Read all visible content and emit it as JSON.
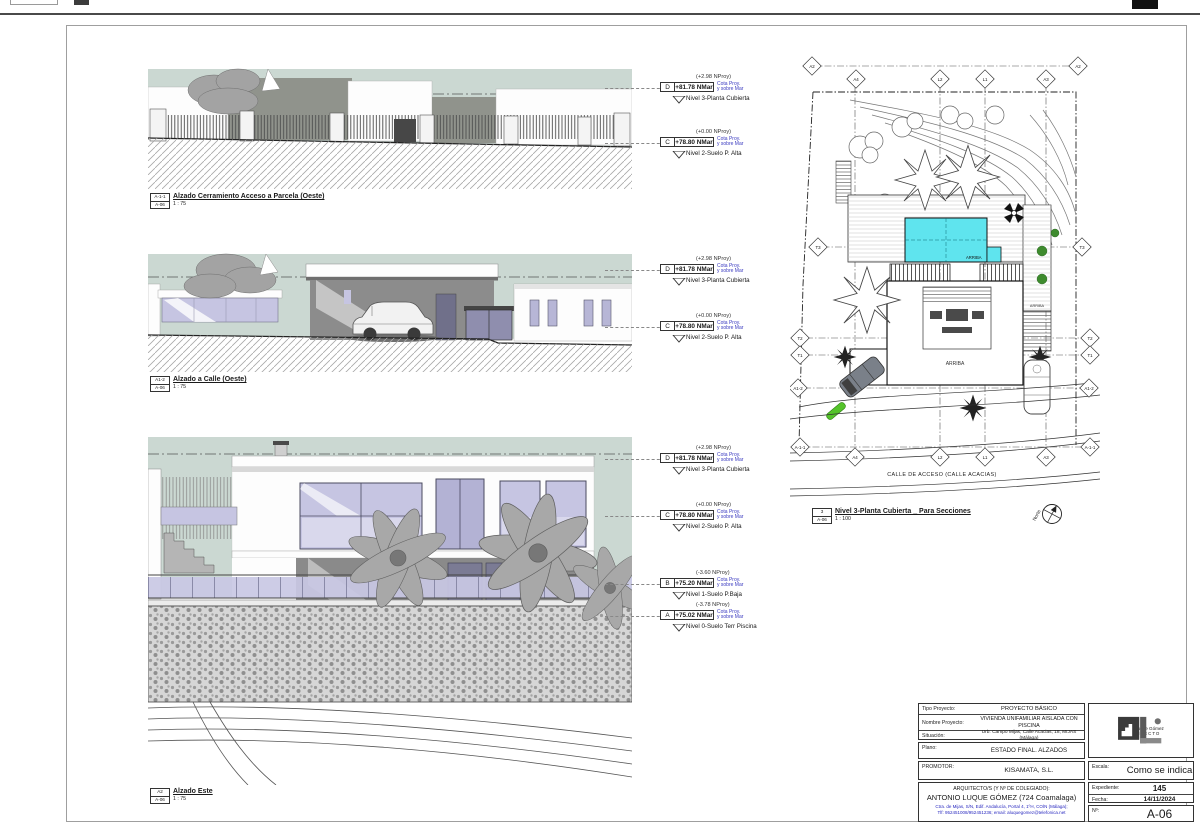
{
  "sheet": {
    "number": "A-06"
  },
  "views": [
    {
      "ref": "A-1-1",
      "sheet": "A-06",
      "title": "Alzado Cerramiento Acceso a Parcela (Oeste)",
      "scale": "1 : 75"
    },
    {
      "ref": "A1-2",
      "sheet": "A-06",
      "title": "Alzado a Calle (Oeste)",
      "scale": "1 : 75"
    },
    {
      "ref": "A2",
      "sheet": "A-06",
      "title": "Alzado Este",
      "scale": "1 : 75"
    }
  ],
  "plan": {
    "ref": "3",
    "sheet": "A-06",
    "title": "Nivel 3-Planta Cubierta _ Para Secciones",
    "scale": "1 : 100",
    "street_label": "CALLE DE ACCESO (CALLE ACACIAS)",
    "arriba_pool": "ARRIBA",
    "arriba_center": "ARRIBA",
    "arriba_right": "ARRIBA",
    "north_label": "Norte",
    "grid_top": [
      "A2",
      "A4",
      "L2",
      "L1",
      "A3",
      "A2"
    ],
    "grid_left": [
      "T3",
      "T2",
      "T1",
      "A1-2"
    ],
    "grid_right": [
      "T3",
      "T2",
      "T1",
      "A1-2"
    ],
    "grid_bottom": [
      "A-1-1",
      "A4",
      "L2",
      "L1",
      "A3",
      "A-1-1"
    ]
  },
  "levels": {
    "cota1": "Cota Proy.",
    "cota2": "y sobre Mar",
    "d": {
      "letter": "D",
      "nproy": "(+2.98 NProy)",
      "value": "+81.78 NMar",
      "name": "Nivel 3-Planta Cubierta"
    },
    "c": {
      "letter": "C",
      "nproy": "(+0.00 NProy)",
      "value": "+78.80 NMar",
      "name": "Nivel 2-Suelo P. Alta"
    },
    "b": {
      "letter": "B",
      "nproy": "(-3.60 NProy)",
      "value": "+75.20 NMar",
      "name": "Nivel 1-Suelo P.Baja"
    },
    "a": {
      "letter": "A",
      "nproy": "(-3.78 NProy)",
      "value": "+75.02 NMar",
      "name": "Nivel 0-Suelo Terr Piscina"
    }
  },
  "title_block": {
    "tipo_label": "Tipo Proyecto:",
    "tipo_value": "PROYECTO BÁSICO",
    "nombre_label": "Nombre Proyecto:",
    "nombre_value": "VIVIENDA UNIFAMILIAR AISLADA CON PISCINA",
    "situacion_label": "Situación:",
    "situacion_value": "Urb. Campo Mijas, Calle Acacias, 18, MIJAS (Málaga)",
    "plano_label": "Plano:",
    "plano_value": "ESTADO FINAL. ALZADOS",
    "promotor_label": "PROMOTOR:",
    "promotor_value": "KISAMATA, S.L.",
    "arquitecto_label": "ARQUITECTO/S (Y Nº DE COLEGIADO):",
    "arquitecto_value": "ANTONIO LUQUE GÓMEZ (724 Coamalaga)",
    "address_line1": "Ctra. de Mijas, S/N, Edif. Andalucía, Portal 4, 1ºH, COÍN (Málaga);",
    "address_line2": "Tlf: 952451008/952451236; email: aluquegomez@telefonica.net",
    "logo_name": "Antonio Luque Gómez",
    "logo_title": "ARQUITECTO",
    "escala_label": "Escala:",
    "escala_value": "Como se indica",
    "expediente_label": "Expediente:",
    "expediente_value": "145",
    "fecha_label": "Fecha:",
    "fecha_value": "14/11/2024",
    "num_label": "Nº:",
    "num_value": "A-06"
  },
  "colors": {
    "sky": "#cbd8d2",
    "pool": "#5fe4ee",
    "glass": "#c6c5e2",
    "blue_text": "#2a2ac0",
    "green": "#3e8b2e"
  }
}
